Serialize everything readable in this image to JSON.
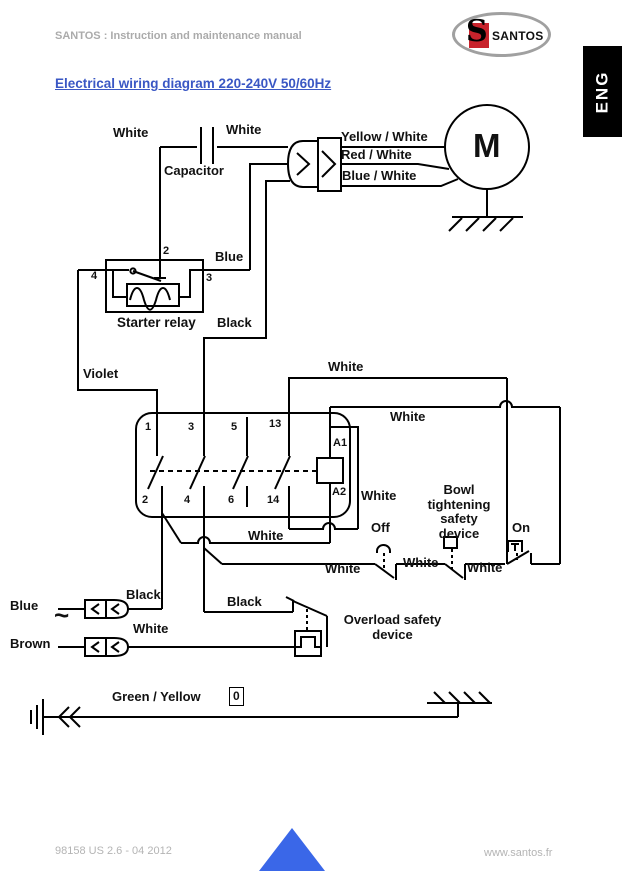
{
  "header": {
    "manual_title": "SANTOS : Instruction and maintenance manual",
    "logo_s": "S",
    "logo_text": "SANTOS",
    "lang_tab": "ENG"
  },
  "title": "Electrical wiring diagram 220-240V  50/60Hz",
  "footer": {
    "doc_ref": "98158 US 2.6 - 04 2012",
    "website": "www.santos.fr"
  },
  "colors": {
    "title_blue": "#3a57c4",
    "triangle_blue": "#3a67e8",
    "logo_red": "#c8232c",
    "muted_gray": "#ababab",
    "line_black": "#000000",
    "contactor_outline_gray": "#999999"
  },
  "diagram": {
    "labels": [
      {
        "name": "wire-white-cap-left",
        "text": "White",
        "x": 113,
        "y": 126
      },
      {
        "name": "wire-white-cap-right",
        "text": "White",
        "x": 226,
        "y": 123
      },
      {
        "name": "capacitor",
        "text": "Capacitor",
        "x": 164,
        "y": 164
      },
      {
        "name": "wire-yellow-white",
        "text": "Yellow / White",
        "x": 341,
        "y": 130
      },
      {
        "name": "wire-red-white",
        "text": "Red / White",
        "x": 341,
        "y": 148
      },
      {
        "name": "wire-blue-white",
        "text": "Blue / White",
        "x": 342,
        "y": 169
      },
      {
        "name": "motor-m",
        "text": "M",
        "x": 473,
        "y": 128,
        "size": 33
      },
      {
        "name": "relay-terminal-2",
        "text": "2",
        "x": 163,
        "y": 245,
        "size": 11
      },
      {
        "name": "wire-blue",
        "text": "Blue",
        "x": 215,
        "y": 250
      },
      {
        "name": "relay-terminal-4",
        "text": "4",
        "x": 91,
        "y": 270,
        "size": 11
      },
      {
        "name": "relay-terminal-3",
        "text": "3",
        "x": 206,
        "y": 272,
        "size": 11
      },
      {
        "name": "starter-relay",
        "text": "Starter relay",
        "x": 117,
        "y": 315,
        "size": 13.5
      },
      {
        "name": "wire-black-upper",
        "text": "Black",
        "x": 217,
        "y": 316
      },
      {
        "name": "wire-violet",
        "text": "Violet",
        "x": 83,
        "y": 367
      },
      {
        "name": "wire-white-13",
        "text": "White",
        "x": 328,
        "y": 360
      },
      {
        "name": "contactor-terminal-1",
        "text": "1",
        "x": 145,
        "y": 421,
        "size": 11
      },
      {
        "name": "contactor-terminal-3",
        "text": "3",
        "x": 188,
        "y": 421,
        "size": 11
      },
      {
        "name": "contactor-terminal-5",
        "text": "5",
        "x": 231,
        "y": 421,
        "size": 11
      },
      {
        "name": "contactor-terminal-13",
        "text": "13",
        "x": 269,
        "y": 418,
        "size": 11
      },
      {
        "name": "coil-terminal-a1",
        "text": "A1",
        "x": 333,
        "y": 437,
        "size": 11
      },
      {
        "name": "wire-white-a1",
        "text": "White",
        "x": 390,
        "y": 410
      },
      {
        "name": "contactor-terminal-2",
        "text": "2",
        "x": 142,
        "y": 494,
        "size": 11
      },
      {
        "name": "contactor-terminal-4",
        "text": "4",
        "x": 184,
        "y": 494,
        "size": 11
      },
      {
        "name": "contactor-terminal-6",
        "text": "6",
        "x": 228,
        "y": 494,
        "size": 11
      },
      {
        "name": "contactor-terminal-14",
        "text": "14",
        "x": 267,
        "y": 494,
        "size": 11
      },
      {
        "name": "coil-terminal-a2",
        "text": "A2",
        "x": 332,
        "y": 486,
        "size": 11
      },
      {
        "name": "wire-white-a2",
        "text": "White",
        "x": 361,
        "y": 489
      },
      {
        "name": "wire-white-14",
        "text": "White",
        "x": 248,
        "y": 529
      },
      {
        "name": "bowl-safety-device",
        "text": "Bowl\ntightening\nsafety\ndevice",
        "x": 424,
        "y": 483,
        "w": 70,
        "align": "center"
      },
      {
        "name": "off-button",
        "text": "Off",
        "x": 371,
        "y": 521
      },
      {
        "name": "on-button",
        "text": "On",
        "x": 512,
        "y": 521
      },
      {
        "name": "wire-white-bottom-left",
        "text": "White",
        "x": 325,
        "y": 562
      },
      {
        "name": "wire-white-bottom-mid",
        "text": "White",
        "x": 403,
        "y": 556
      },
      {
        "name": "wire-white-bottom-right",
        "text": "White",
        "x": 467,
        "y": 561
      },
      {
        "name": "wire-black-blue-row",
        "text": "Black",
        "x": 126,
        "y": 588
      },
      {
        "name": "input-blue",
        "text": "Blue",
        "x": 10,
        "y": 599
      },
      {
        "name": "ac-tilde",
        "text": "~",
        "x": 54,
        "y": 601,
        "size": 26
      },
      {
        "name": "input-brown",
        "text": "Brown",
        "x": 10,
        "y": 637
      },
      {
        "name": "wire-white-brown-row",
        "text": "White",
        "x": 133,
        "y": 622
      },
      {
        "name": "wire-black-overload",
        "text": "Black",
        "x": 227,
        "y": 595
      },
      {
        "name": "overload-safety-device",
        "text": "Overload safety\ndevice",
        "x": 340,
        "y": 613,
        "w": 105,
        "align": "center"
      },
      {
        "name": "wire-green-yellow",
        "text": "Green / Yellow",
        "x": 112,
        "y": 690
      },
      {
        "name": "ground-zero",
        "text": "0",
        "x": 229,
        "y": 687,
        "size": 12,
        "boxed": true
      }
    ]
  }
}
